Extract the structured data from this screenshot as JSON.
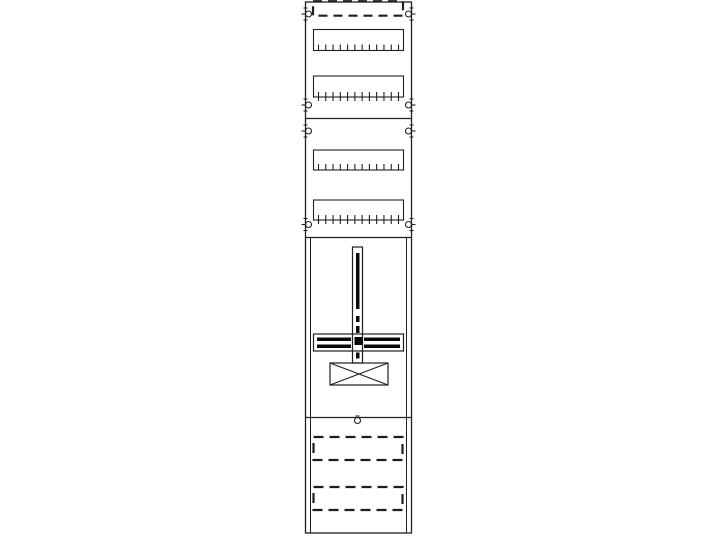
{
  "page": {
    "background_color": "#ffffff"
  },
  "diagram": {
    "name": "meter-board-panel-technical-drawing",
    "stroke_color": "#1f1f1f",
    "fill_color": "#0a0a0a",
    "canvas": {
      "width": 716,
      "height": 540
    },
    "panel_outline": {
      "x": 305.5,
      "y": 2,
      "width": 106,
      "height": 531
    },
    "inner_side_lines": {
      "left_x": 310.5,
      "right_x": 406.5,
      "y1": 237.5,
      "y2": 533
    },
    "section_dividers_y": [
      118.5,
      237.5,
      417.5
    ],
    "top_cover_strip": {
      "x": 313,
      "y": 1.2,
      "width": 90,
      "height": 14.5,
      "dash": "9 6",
      "stroke_width": 2.2
    },
    "din_rails": [
      {
        "x": 313.5,
        "y": 29.5,
        "width": 90,
        "height": 21,
        "ticks": 12,
        "tick_style": "inside"
      },
      {
        "x": 313.5,
        "y": 76,
        "width": 90,
        "height": 21,
        "ticks": 12,
        "tick_style": "crossing"
      },
      {
        "x": 313.5,
        "y": 150,
        "width": 90,
        "height": 20,
        "ticks": 12,
        "tick_style": "inside"
      },
      {
        "x": 313.5,
        "y": 200,
        "width": 90,
        "height": 20,
        "ticks": 12,
        "tick_style": "crossing"
      }
    ],
    "screw_radius": 3,
    "fixing_screws": [
      {
        "cx": 308.5,
        "cy": 14,
        "side": "left"
      },
      {
        "cx": 408.5,
        "cy": 14,
        "side": "right"
      },
      {
        "cx": 308.5,
        "cy": 105,
        "side": "left"
      },
      {
        "cx": 408.5,
        "cy": 105,
        "side": "right"
      },
      {
        "cx": 308.5,
        "cy": 131,
        "side": "left"
      },
      {
        "cx": 408.5,
        "cy": 131,
        "side": "right"
      },
      {
        "cx": 308.5,
        "cy": 224.5,
        "side": "left"
      },
      {
        "cx": 408.5,
        "cy": 224.5,
        "side": "right"
      }
    ],
    "meter_mounting": {
      "vertical_rail": {
        "x": 352.5,
        "y": 247,
        "width": 10,
        "height": 116
      },
      "slot": {
        "x": 356,
        "y": 253,
        "width": 3.5,
        "height": 56
      },
      "marks": [
        {
          "x": 356,
          "y": 316,
          "width": 3.5,
          "height": 6
        },
        {
          "x": 356,
          "y": 326,
          "width": 3.5,
          "height": 7
        },
        {
          "x": 356,
          "y": 352.5,
          "width": 3.5,
          "height": 6
        }
      ],
      "cross_bar": {
        "x": 313.5,
        "y": 334,
        "width": 90,
        "height": 17
      },
      "bar_stripes": [
        {
          "x": 317,
          "y": 337.5,
          "width": 34,
          "height": 3.5
        },
        {
          "x": 364,
          "y": 337.5,
          "width": 36,
          "height": 3.5
        },
        {
          "x": 317,
          "y": 344.5,
          "width": 34,
          "height": 3.5
        },
        {
          "x": 364,
          "y": 344.5,
          "width": 36,
          "height": 3.5
        }
      ],
      "center_block": {
        "x": 354.5,
        "y": 337,
        "width": 8,
        "height": 8
      },
      "terminal_box": {
        "x": 330,
        "y": 363,
        "width": 58,
        "height": 22
      }
    },
    "bottom_section": {
      "screw_circle": {
        "cx": 357.5,
        "cy": 420.5,
        "r": 3
      },
      "dash": "10 6",
      "stroke_width": 2.2,
      "dashed_panels": [
        {
          "x": 313.5,
          "y": 437,
          "width": 89,
          "height": 23
        },
        {
          "x": 313.5,
          "y": 487,
          "width": 89,
          "height": 23
        }
      ]
    }
  }
}
